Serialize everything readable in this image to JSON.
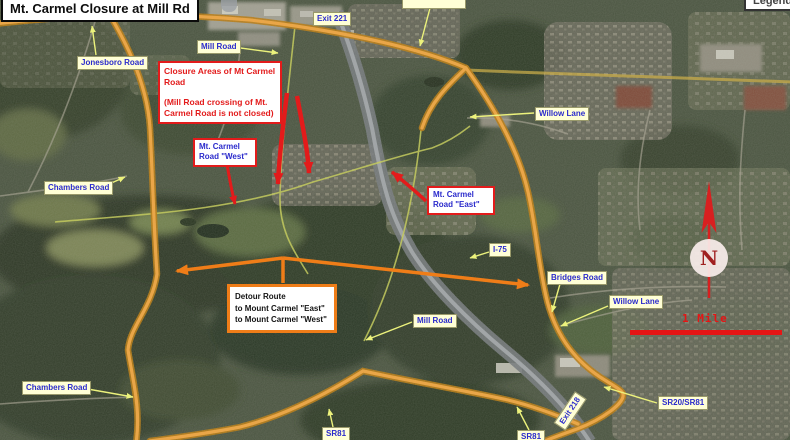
{
  "window": {
    "title": "Mt. Carmel Closure at Mill Rd",
    "legend": "Legend"
  },
  "annotations": {
    "closure": {
      "para1": "Closure Areas of Mt Carmel Road",
      "para2": "(Mill Road crossing of Mt. Carmel Road is not closed)"
    },
    "west": {
      "text": "Mt. Carmel Road \"West\""
    },
    "east": {
      "text": "Mt. Carmel Road \"East\""
    },
    "detour": {
      "line1": "Detour Route",
      "line2": "to Mount Carmel \"East\"",
      "line3": "to Mount Carmel \"West\""
    }
  },
  "map_labels": [
    {
      "id": "jonesboro-road",
      "text": "Jonesboro Road",
      "x": 77,
      "y": 56
    },
    {
      "id": "mill-road-north",
      "text": "Mill Road",
      "x": 197,
      "y": 40
    },
    {
      "id": "exit-221",
      "text": "Exit 221",
      "x": 313,
      "y": 12
    },
    {
      "id": "willow-lane-north",
      "text": "Willow Lane",
      "x": 535,
      "y": 107
    },
    {
      "id": "chambers-road-west",
      "text": "Chambers Road",
      "x": 44,
      "y": 181
    },
    {
      "id": "i-75",
      "text": "I-75",
      "x": 489,
      "y": 243
    },
    {
      "id": "bridges-road",
      "text": "Bridges Road",
      "x": 547,
      "y": 271
    },
    {
      "id": "willow-lane-east",
      "text": "Willow Lane",
      "x": 609,
      "y": 295
    },
    {
      "id": "mill-road-center",
      "text": "Mill Road",
      "x": 413,
      "y": 314
    },
    {
      "id": "chambers-road-south",
      "text": "Chambers Road",
      "x": 22,
      "y": 381
    },
    {
      "id": "sr81-west",
      "text": "SR81",
      "x": 322,
      "y": 427
    },
    {
      "id": "sr81-east",
      "text": "SR81",
      "x": 517,
      "y": 430
    },
    {
      "id": "exit-218",
      "text": "Exit 218",
      "x": 551,
      "y": 404,
      "rotate": -56
    },
    {
      "id": "sr20-sr81",
      "text": "SR20/SR81",
      "x": 658,
      "y": 396
    },
    {
      "id": "clipped-top-label",
      "text": "",
      "x": 402,
      "y": -5,
      "w": 56,
      "h": 10
    }
  ],
  "compass": {
    "label": "N"
  },
  "scale_bar": {
    "label": "1 Mile"
  },
  "colors": {
    "detour_orange": "#ef7d18",
    "closure_red": "#e31b1b",
    "road_label_blue": "#2b2bcc",
    "road_label_bg": "#ffffd6",
    "highlight_road": "#f0a43c",
    "scale_red": "#e51515"
  }
}
